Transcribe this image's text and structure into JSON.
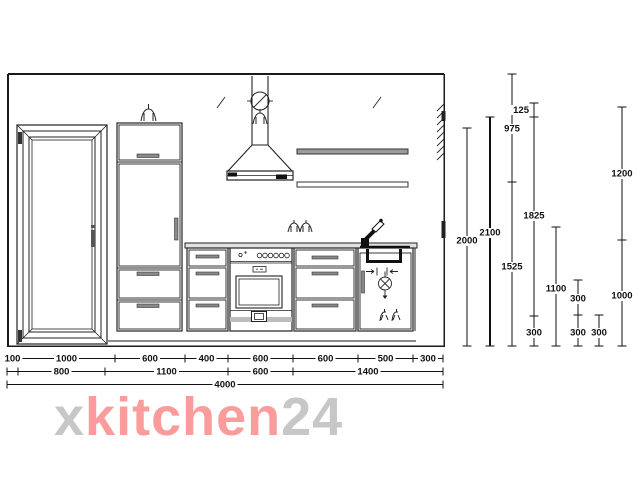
{
  "drawing": {
    "type": "kitchen-elevation-technical-drawing",
    "elements": [
      "entry-door",
      "tall-cabinet",
      "cooker-hood",
      "wall-shelf-upper",
      "wall-shelf-lower",
      "base-cabinet",
      "oven-cabinet",
      "drawer-cabinet",
      "sink-cabinet",
      "worktop",
      "faucet",
      "sink",
      "socket-symbol",
      "lamp-symbol",
      "water-connection-symbol",
      "drain-symbol"
    ]
  },
  "dims": {
    "h1": [
      "100",
      "1000",
      "600",
      "400",
      "600",
      "600",
      "500",
      "300"
    ],
    "h2": [
      "800",
      "1100",
      "600",
      "1400"
    ],
    "total": "4000",
    "v": [
      "2000",
      "2100",
      "975",
      "1525",
      "125",
      "1825",
      "300",
      "1100",
      "300",
      "300",
      "300",
      "1200",
      "1000"
    ]
  },
  "watermark": {
    "x": "x",
    "kitchen": "kitchen",
    "n24": "24"
  },
  "colors": {
    "watermark_pink": "#fa9c9c",
    "watermark_gray": "#c7c7c7",
    "line": "#1a1a1a",
    "background": "#ffffff"
  }
}
